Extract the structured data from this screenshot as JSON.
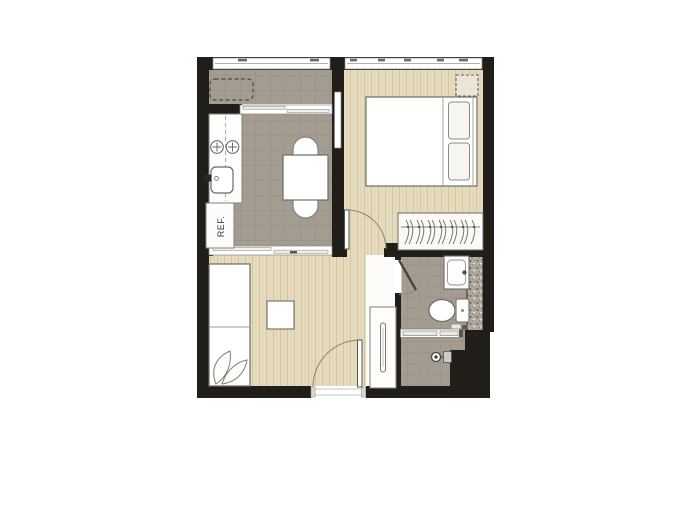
{
  "labels": {
    "refrigerator": "REF."
  },
  "colors": {
    "wall": "#211e1a",
    "wood_floor": "#e6dcbd",
    "wood_plank_line": "#d2c5a2",
    "tile_floor": "#a49c90",
    "tile_grid_line": "#968e82",
    "shaft_fill": "#b2aa9e",
    "fixture_fill": "#ffffff",
    "fixture_outline": "#777770",
    "door_arc": "#8d857a",
    "dashed_outline": "#4f4a44",
    "background": "#ffffff"
  },
  "rooms": [
    {
      "name": "balcony",
      "floor": "tile"
    },
    {
      "name": "kitchen-dining",
      "floor": "tile"
    },
    {
      "name": "bedroom",
      "floor": "wood"
    },
    {
      "name": "living-room",
      "floor": "wood"
    },
    {
      "name": "foyer",
      "floor": "plain"
    },
    {
      "name": "bathroom",
      "floor": "tile"
    }
  ],
  "furniture": [
    "ac-unit-dashed-position",
    "kitchen-counter",
    "two-burner-hob",
    "kitchen-sink",
    "refrigerator-position",
    "dining-table",
    "dining-chairs",
    "double-bed",
    "two-pillows",
    "bedside-dashed-position",
    "wardrobe-with-hangers",
    "sofa-bed",
    "cushions",
    "coffee-table",
    "tall-cabinet"
  ],
  "fixtures": [
    "wash-basin",
    "toilet",
    "toilet-spray",
    "shower-screen",
    "shower-mixer",
    "pipe-shaft",
    "entrance-door",
    "bedroom-door",
    "bathroom-door",
    "balcony-window",
    "bedroom-window",
    "balcony-sliding-window",
    "kitchen-living-partition",
    "interior-glass-panel"
  ]
}
